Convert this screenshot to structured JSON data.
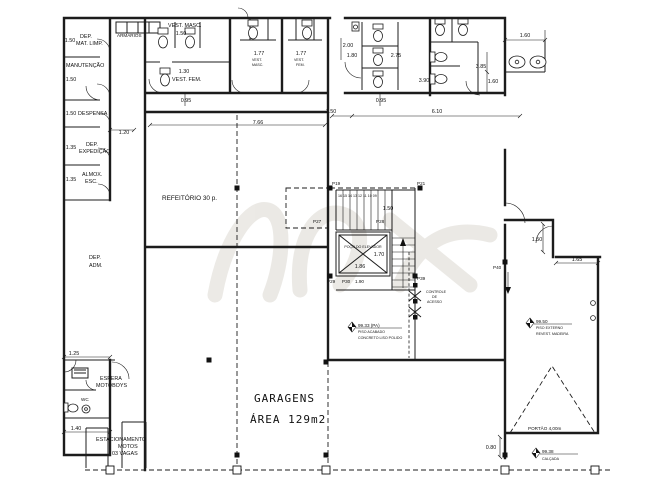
{
  "drawing": {
    "type": "architectural-floor-plan",
    "ink_color": "#1c1c1c",
    "watermark_color": "#d9d5cd"
  },
  "rooms": {
    "dep_mat_limp_1": "DEP.",
    "dep_mat_limp_2": "MAT. LIMP.",
    "manutencao": "MANUTENÇÃO",
    "despensa": "DESPENSA",
    "dep_expedicao_1": "DEP.",
    "dep_expedicao_2": "EXPEDIÇÃO",
    "almox_1": "ALMOX.",
    "almox_2": "ESC.",
    "dep_adm_1": "DEP.",
    "dep_adm_2": "ADM.",
    "espera_1": "ESPERA",
    "espera_2": "MOTOBOYS",
    "wc": "WC",
    "estacionamento_1": "ESTACIONAMENTO",
    "estacionamento_2": "MOTOS",
    "estacionamento_3": "03 VAGAS",
    "armarios": "ARMÁRIOS",
    "vest_masc_1": "VEST. MASC.",
    "vest_fem_1": "VEST. FEM.",
    "vest_2a_1": "VEST.",
    "vest_2a_2": "MASC.",
    "vest_2b_1": "VEST.",
    "vest_2b_2": "FEM.",
    "refeitorio": "REFEITÓRIO 30 p.",
    "garagens": "GARAGENS",
    "garagens_area": "ÁREA 129m2",
    "elevador": "POÇO DO ELEVADOR",
    "controle_1": "CONTROLE",
    "controle_2": "DE",
    "controle_3": "ACESSO"
  },
  "dims": {
    "d150_dep": "1.50",
    "d150_man": "1.50",
    "d150_desp": "1.50",
    "d120": "1.20",
    "d135_exp": "1.35",
    "d135_alm": "1.35",
    "d125": "1.25",
    "d140": "1.40",
    "d150_vest": "1.50",
    "d130": "1.30",
    "d095_vest": "0.95",
    "d766": "7.66",
    "d177_m": "1.77",
    "d177_f": "1.77",
    "d200": "2.00",
    "d180": "1.80",
    "d275": "2.75",
    "d390": "3.90",
    "d095_san": "0.95",
    "d150_hall": "1.50",
    "d610": "6.10",
    "d385": "3.85",
    "d160_wc": "1.60",
    "d160_top": "1.60",
    "d150_stair": "1.50",
    "d170": "1.70",
    "d186": "1.86",
    "d190": "1.90",
    "d150_sala": "1.50",
    "d165": "1.65",
    "d080": "0.80"
  },
  "doors": {
    "p19": "P19",
    "p21": "P21",
    "p27": "P27",
    "p28": "P28",
    "p29": "P29",
    "p30": "P30",
    "p39": "P39",
    "p40": "P40"
  },
  "stair": {
    "numbers": "16 15 14 13 12 11 10 09"
  },
  "levels": {
    "pa_value": "99.33 (PA)",
    "pa_sub1": "PISO ACABADO",
    "pa_sub2": "CONCRETO LISO POLIDO",
    "ext_value": "99.50",
    "ext_sub1": "PISO EXTERNO",
    "ext_sub2": "REVEST. MADEIRA",
    "cal_value": "99.38",
    "cal_sub1": "CALÇADA"
  },
  "notes": {
    "gate": "PORTÃO 4,00m"
  }
}
